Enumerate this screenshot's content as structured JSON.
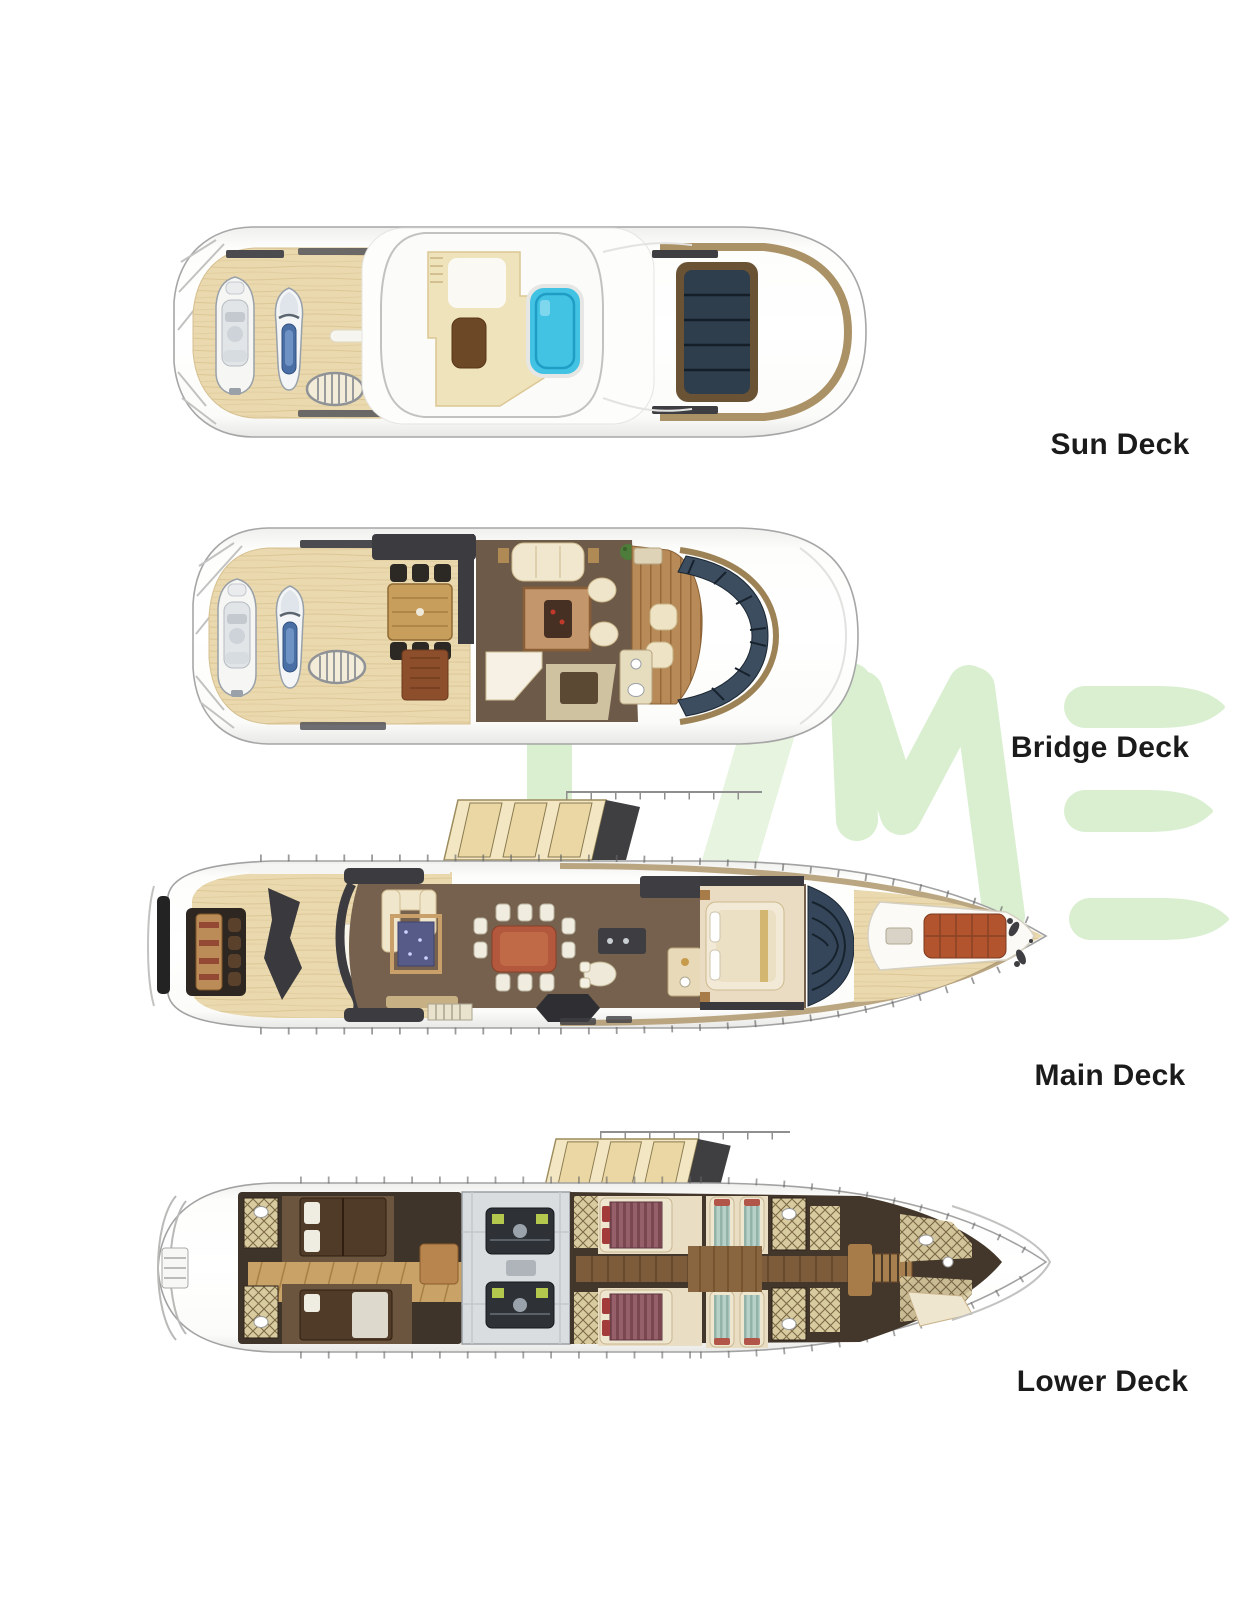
{
  "page": {
    "background": "#ffffff"
  },
  "watermark": {
    "letters": "IME",
    "color": "#d9efd0"
  },
  "decks": [
    {
      "id": "sun-deck",
      "label": "Sun Deck"
    },
    {
      "id": "bridge-deck",
      "label": "Bridge Deck"
    },
    {
      "id": "main-deck",
      "label": "Main Deck"
    },
    {
      "id": "lower-deck",
      "label": "Lower Deck"
    }
  ],
  "palette": {
    "label_text": "#1b1b1b",
    "hull_white": "#fcfcfb",
    "hull_outline": "#a2a2a2",
    "teak_deck": "#ead9ae",
    "interior_floor_brown": "#75614d",
    "dark_structure": "#3c3c40",
    "cream_furniture": "#efe6cc",
    "pool_blue": "#42c3e4",
    "glass_dark": "#35465a",
    "bronze_trim": "#a68c5e",
    "vip_bed_maroon": "#8d5862",
    "twin_bed_teal": "#a9c7bf",
    "engine_room_gray": "#dadde0",
    "accent_wood": "#b98a58",
    "watermark_green": "#d9efd0"
  }
}
